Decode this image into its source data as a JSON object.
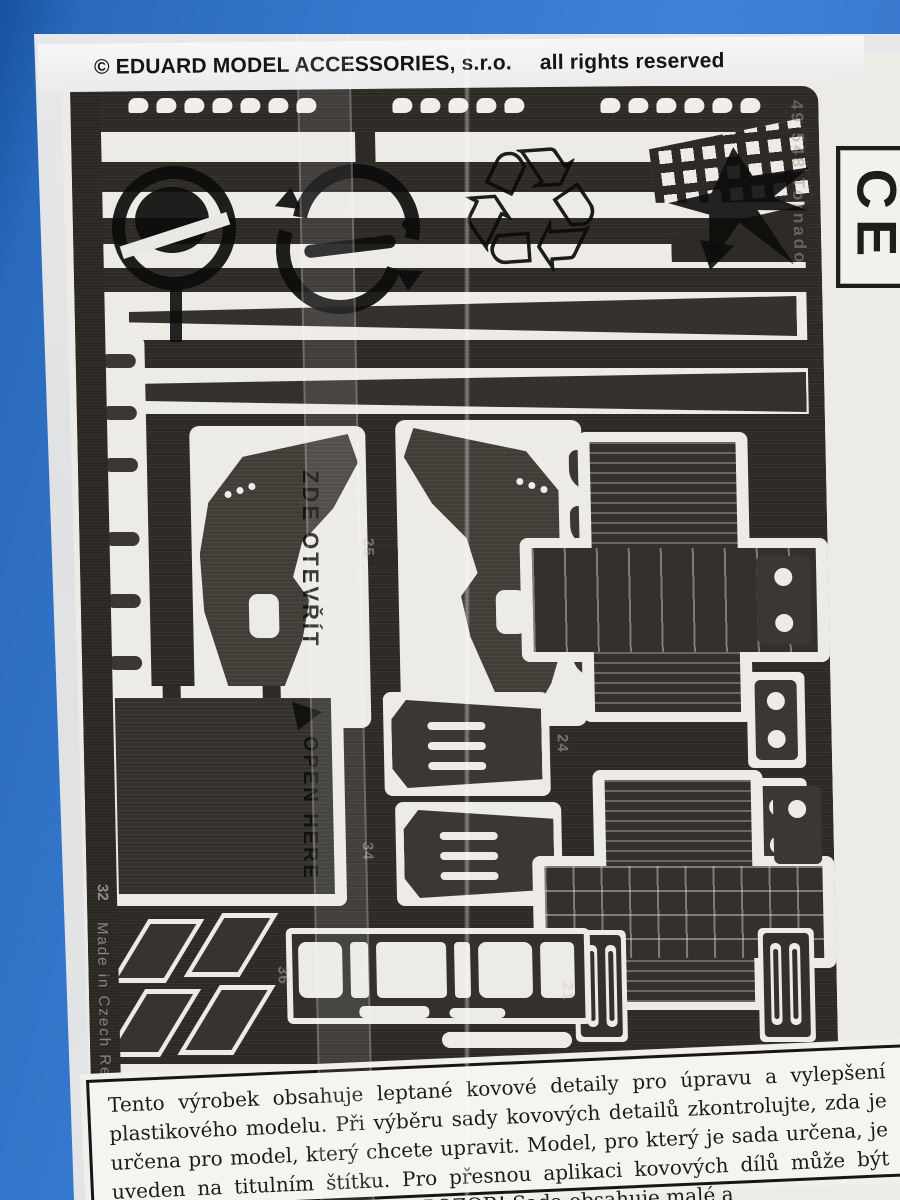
{
  "header": {
    "company": "© EDUARD MODEL ACCESSORIES, s.r.o.",
    "rights": "all rights reserved"
  },
  "ce_mark": {
    "text": "CE"
  },
  "bag": {
    "open_here_cz": "ZDE OTEVŘÍT",
    "open_here_en": "OPEN HERE"
  },
  "fret": {
    "right_edge_code": "49 548 Tornado",
    "left_edge_origin": "Made in Czech Rep",
    "part_numbers": {
      "n21": "21",
      "n24": "24",
      "n25": "25",
      "n32": "32",
      "n34": "34",
      "n36": "36"
    }
  },
  "label": {
    "line1": "Tento výrobek obsahuje leptané kovové detaily pro úpravu a vylepšení",
    "line2": "plastikového modelu. Při výběru sady kovových detailů zkontrolujte, zda je",
    "line3": "určena pro model, který chcete upravit. Model, pro který je sada určena, je",
    "line4": "uveden na titulním štítku. Pro přesnou aplikaci kovových dílů může být",
    "line5_partial": "POZOR! Sada obsahuje malé a"
  },
  "colors": {
    "background_blue": "#3376cb",
    "bag_white": "#e3e4e5",
    "card_white": "#edebe6",
    "fret_dark": "#2e2b27",
    "print_black": "#0c0c0c"
  }
}
